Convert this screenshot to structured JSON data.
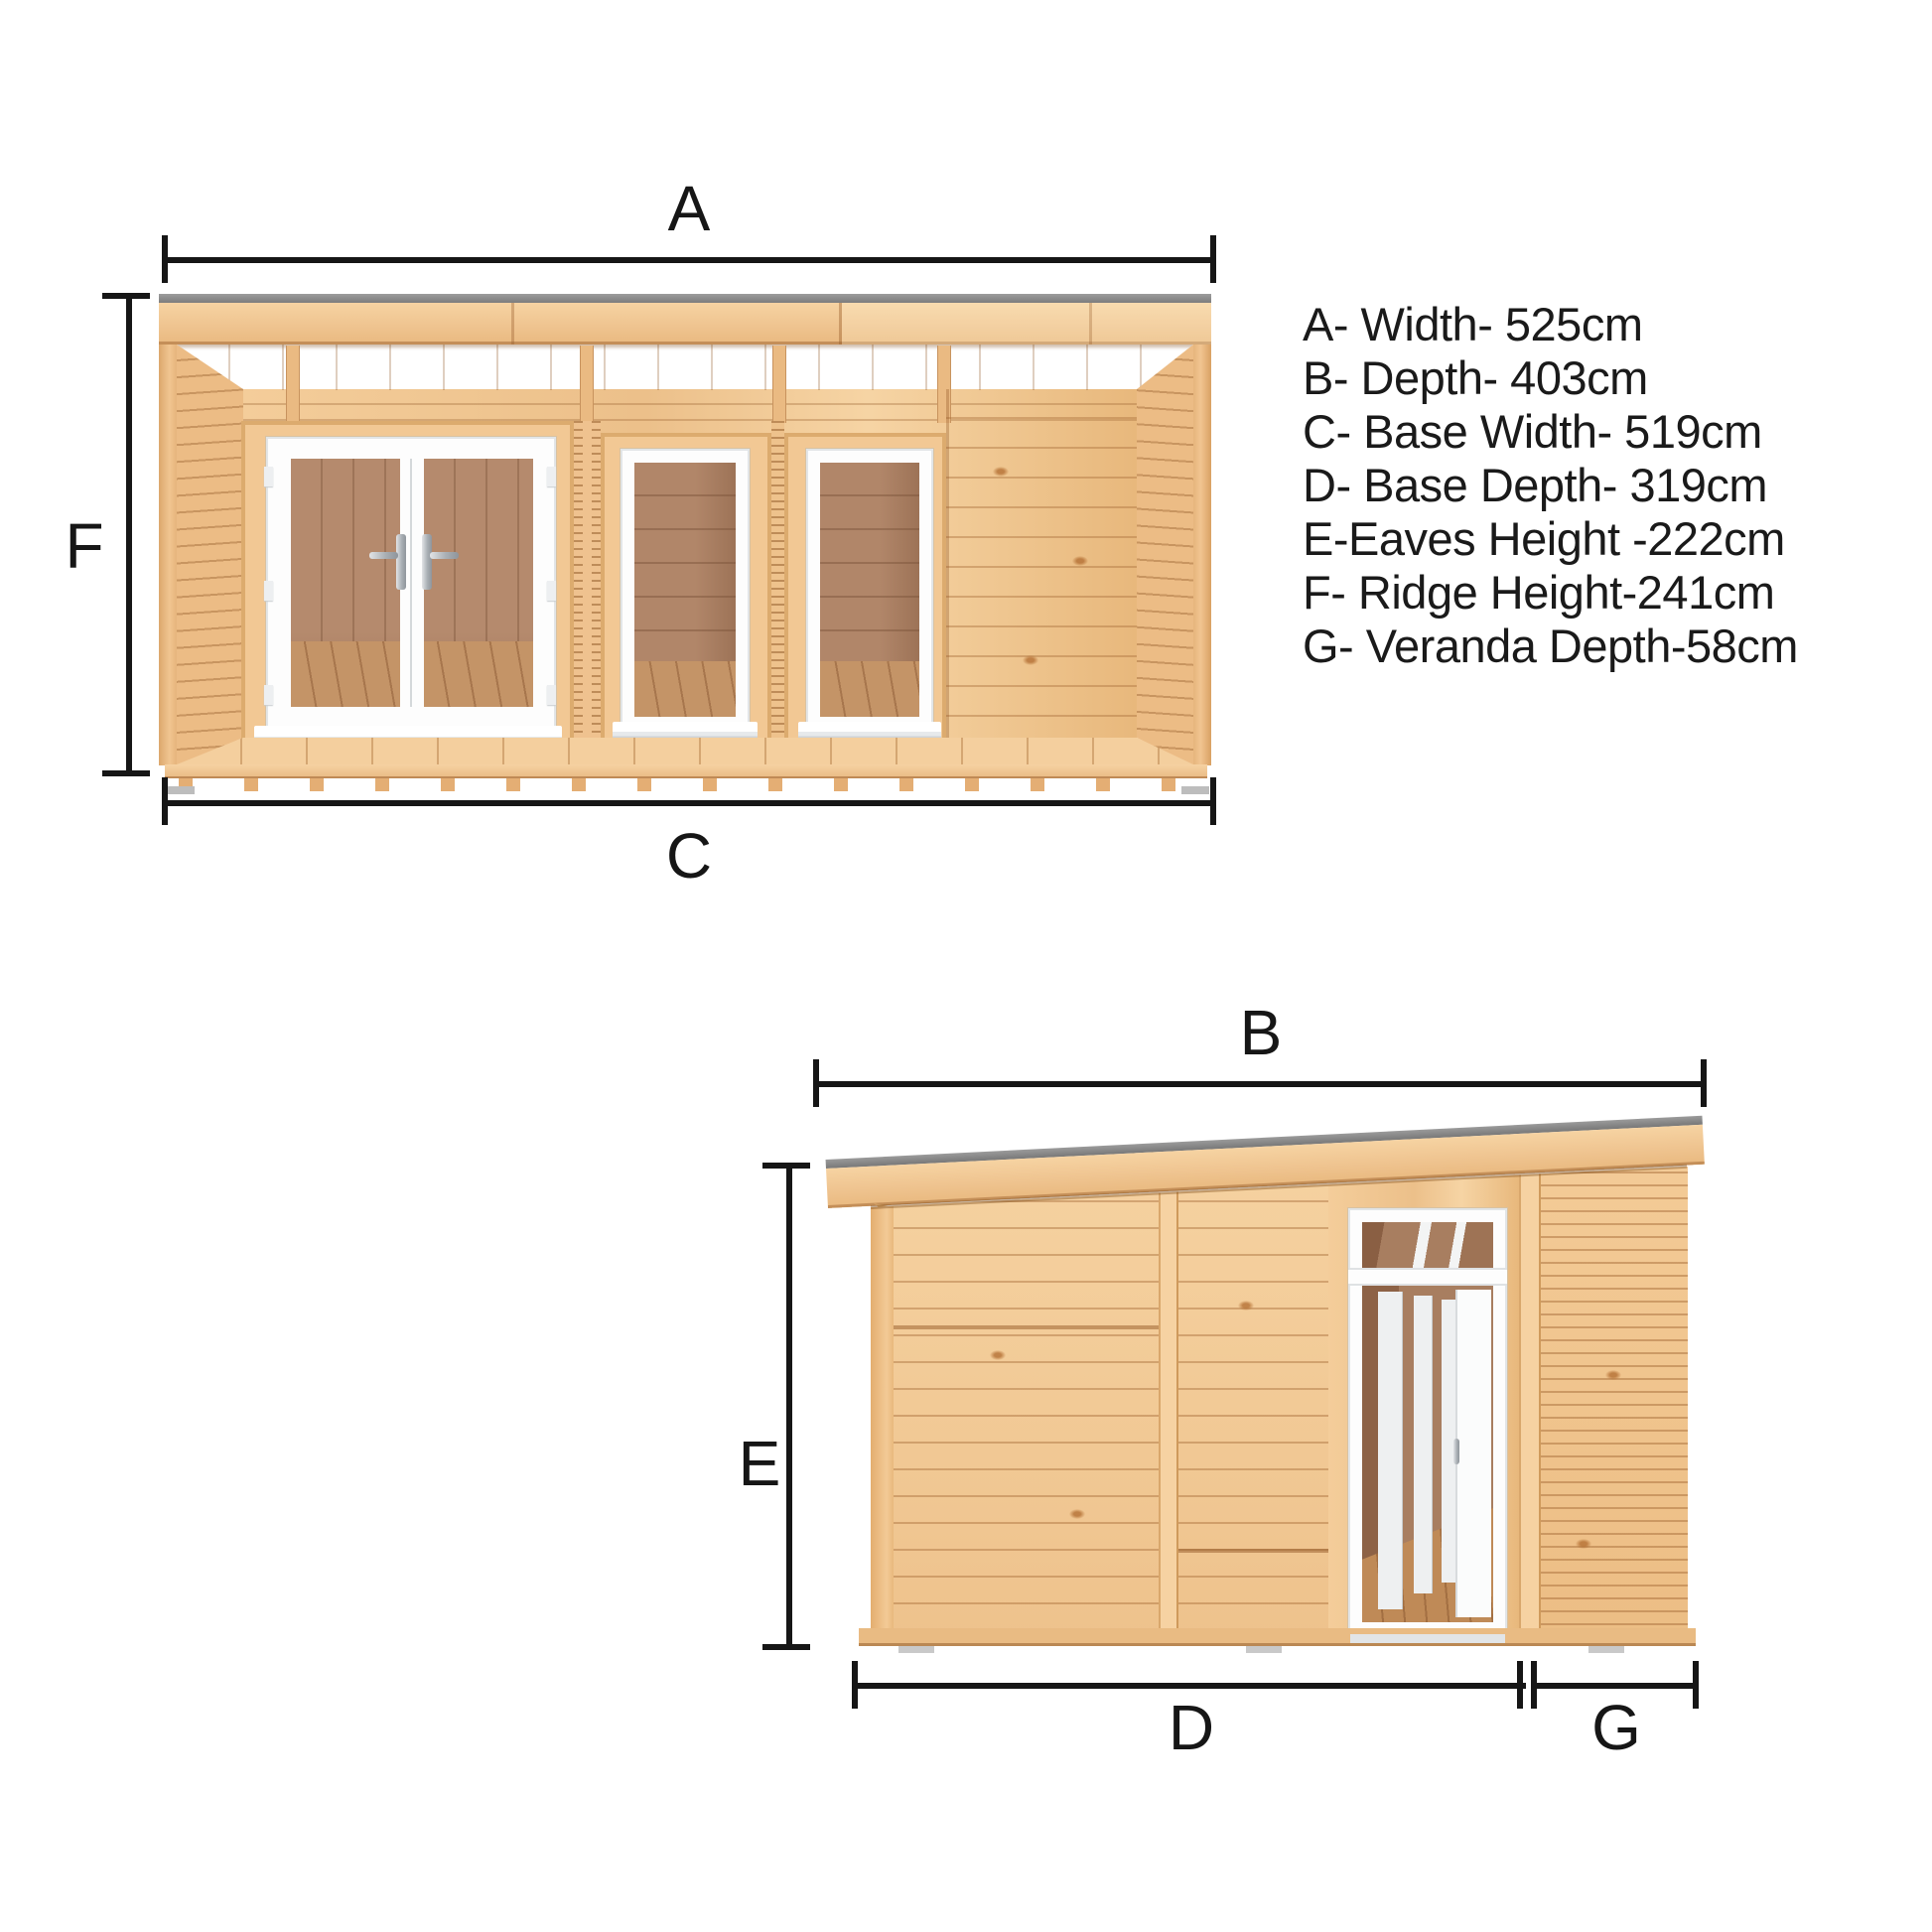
{
  "palette": {
    "line": "#161616",
    "text": "#1a1a1a",
    "wood_light": "#f6d3a2",
    "wood_mid": "#eec28c",
    "wood_deep": "#e3ad6f",
    "groove_brown": "#a96f3b",
    "roof_gray": "#8d8d8d",
    "frame_white": "#fdfdfd",
    "interior_wall_brown": "#ab8165",
    "interior_floor_brown": "#c49467"
  },
  "legend": {
    "items": [
      {
        "letter": "A",
        "label": "Width",
        "value_cm": 525,
        "text": "A- Width- 525cm"
      },
      {
        "letter": "B",
        "label": "Depth",
        "value_cm": 403,
        "text": "B- Depth- 403cm"
      },
      {
        "letter": "C",
        "label": "Base Width",
        "value_cm": 519,
        "text": "C- Base Width- 519cm"
      },
      {
        "letter": "D",
        "label": "Base Depth",
        "value_cm": 319,
        "text": "D- Base Depth- 319cm"
      },
      {
        "letter": "E",
        "label": "Eaves Height",
        "value_cm": 222,
        "text": "E-Eaves Height -222cm"
      },
      {
        "letter": "F",
        "label": "Ridge Height",
        "value_cm": 241,
        "text": "F- Ridge Height-241cm"
      },
      {
        "letter": "G",
        "label": "Veranda Depth",
        "value_cm": 58,
        "text": "G- Veranda Depth-58cm"
      }
    ]
  },
  "front_view": {
    "labels": {
      "width": "A",
      "ridge_height": "F",
      "base_width": "C"
    }
  },
  "side_view": {
    "labels": {
      "depth": "B",
      "eaves_height": "E",
      "base_depth": "D",
      "veranda_depth": "G"
    }
  }
}
